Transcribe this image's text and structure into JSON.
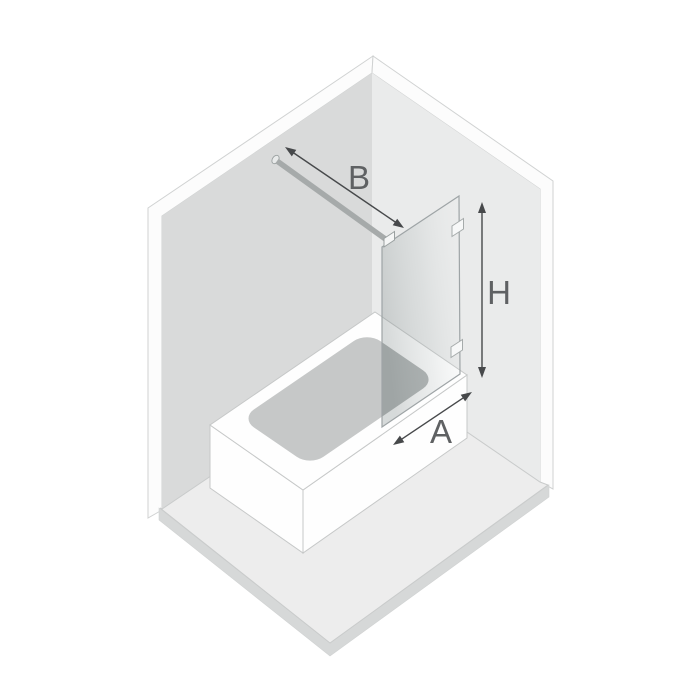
{
  "diagram": {
    "kind": "bath-screen-dimension-diagram",
    "labels": {
      "bar_span": "B",
      "screen_height": "H",
      "screen_width": "A"
    },
    "colors": {
      "background": "#ffffff",
      "wall_left": "#d9dada",
      "wall_right": "#eaebeb",
      "wall_top_band": "#fcfcfc",
      "floor": "#ededed",
      "floor_edge": "#d6d8d8",
      "bathtub": "#fefefe",
      "basin": "#c6c8c8",
      "basin_behind_glass": "#a9acac",
      "glass_edge": "#9ea4a6",
      "support_bar": "#a6aaaa",
      "arrow": "#47494b",
      "label_text": "#5f6163"
    }
  }
}
